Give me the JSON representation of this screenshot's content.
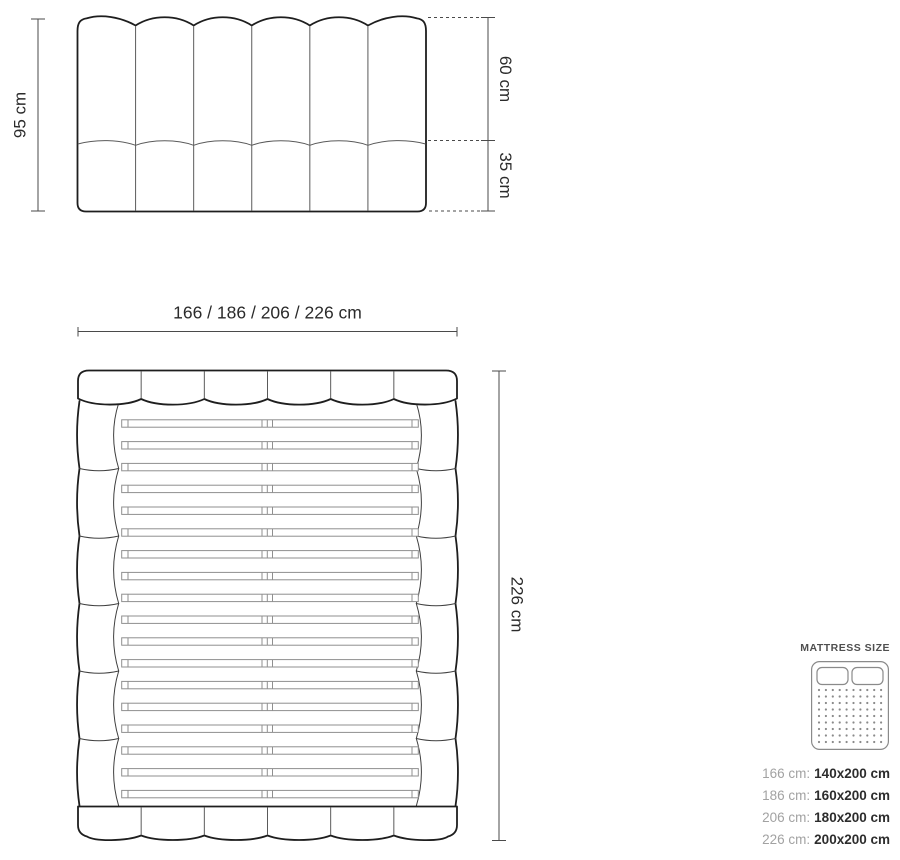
{
  "diagram": {
    "front_view": {
      "height_label": "95 cm",
      "upper_height_label": "60 cm",
      "lower_height_label": "35 cm",
      "channel_count": 6
    },
    "top_view": {
      "width_label": "166 / 186 / 206 / 226 cm",
      "length_label": "226 cm",
      "header_segment_count": 6,
      "footer_segment_count": 6,
      "side_segment_count": 6,
      "slat_count": 18
    },
    "legend": {
      "title": "MATTRESS SIZE",
      "rows": [
        {
          "frame": "166 cm:",
          "mattress": "140x200 cm"
        },
        {
          "frame": "186 cm:",
          "mattress": "160x200 cm"
        },
        {
          "frame": "206 cm:",
          "mattress": "180x200 cm"
        },
        {
          "frame": "226 cm:",
          "mattress": "200x200 cm"
        }
      ]
    },
    "colors": {
      "outline": "#1e1e1e",
      "thin_line": "#5a5a5a",
      "slat_line": "#8f8f8f",
      "dimension_line": "#4a4a4a",
      "label_text": "#2b2b2b",
      "legend_muted": "#a2a2a2",
      "legend_value": "#2d2d2d",
      "legend_icon": "#8a8a8a",
      "background": "#ffffff"
    }
  }
}
